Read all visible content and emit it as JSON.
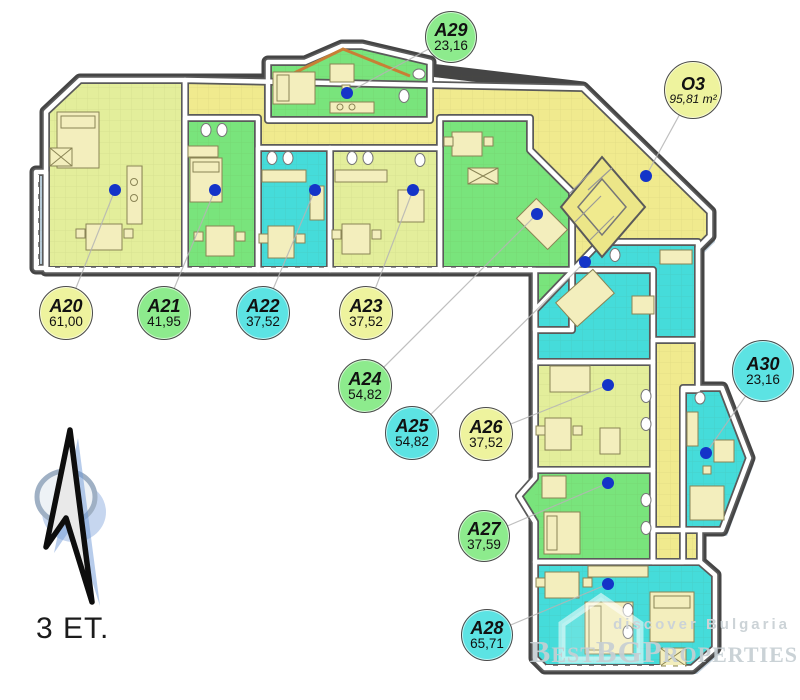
{
  "floor": {
    "label": "3 ET."
  },
  "watermark": {
    "small": "discover Bulgaria",
    "brand": "BestBGProperties"
  },
  "compass": {
    "type": "north-arrow"
  },
  "colors": {
    "fills": {
      "yellow": "#e3ee9b",
      "green": "#79e47c",
      "cyan": "#45dcda",
      "corridor": "#f0ea8e",
      "balcony": "#b5c9d6"
    },
    "label_fills": {
      "yellow": "#eef39e",
      "green": "#8deb8d",
      "cyan": "#5ce3e3"
    },
    "wall": "#ffffff",
    "wall_dark": "#5a5a5a",
    "outline": "#454545",
    "shadow": "#b2c6d6",
    "door_dot": "#1434c8",
    "leader": "#b5b5b5",
    "furniture": "#f3eebd",
    "roof": "#c87f35"
  },
  "units": [
    {
      "id": "A20",
      "area": "61,00",
      "fill": "yellow",
      "circle": {
        "x": 66,
        "y": 313,
        "r": 27
      },
      "dot": {
        "x": 115,
        "y": 190
      }
    },
    {
      "id": "A21",
      "area": "41,95",
      "fill": "green",
      "circle": {
        "x": 164,
        "y": 313,
        "r": 27
      },
      "dot": {
        "x": 215,
        "y": 190
      }
    },
    {
      "id": "A22",
      "area": "37,52",
      "fill": "cyan",
      "circle": {
        "x": 263,
        "y": 313,
        "r": 27
      },
      "dot": {
        "x": 315,
        "y": 190
      }
    },
    {
      "id": "A23",
      "area": "37,52",
      "fill": "yellow",
      "circle": {
        "x": 366,
        "y": 313,
        "r": 27
      },
      "dot": {
        "x": 413,
        "y": 190
      }
    },
    {
      "id": "A24",
      "area": "54,82",
      "fill": "green",
      "circle": {
        "x": 365,
        "y": 386,
        "r": 27
      },
      "dot": {
        "x": 537,
        "y": 214
      }
    },
    {
      "id": "A25",
      "area": "54,82",
      "fill": "cyan",
      "circle": {
        "x": 412,
        "y": 433,
        "r": 27
      },
      "dot": {
        "x": 585,
        "y": 262
      }
    },
    {
      "id": "A26",
      "area": "37,52",
      "fill": "yellow",
      "circle": {
        "x": 486,
        "y": 434,
        "r": 27
      },
      "dot": {
        "x": 608,
        "y": 385
      }
    },
    {
      "id": "A27",
      "area": "37,59",
      "fill": "green",
      "circle": {
        "x": 484,
        "y": 536,
        "r": 26
      },
      "dot": {
        "x": 608,
        "y": 483
      }
    },
    {
      "id": "A28",
      "area": "65,71",
      "fill": "cyan",
      "circle": {
        "x": 487,
        "y": 635,
        "r": 26
      },
      "dot": {
        "x": 608,
        "y": 584
      }
    },
    {
      "id": "A29",
      "area": "23,16",
      "fill": "green",
      "circle": {
        "x": 451,
        "y": 37,
        "r": 26
      },
      "dot": {
        "x": 347,
        "y": 93
      }
    },
    {
      "id": "A30",
      "area": "23,16",
      "fill": "cyan",
      "circle": {
        "x": 763,
        "y": 371,
        "r": 31
      },
      "dot": {
        "x": 706,
        "y": 453
      }
    },
    {
      "id": "O3",
      "area": "95,81 m²",
      "fill": "yellow",
      "circle": {
        "x": 693,
        "y": 90,
        "r": 29
      },
      "dot": {
        "x": 646,
        "y": 176
      }
    }
  ]
}
